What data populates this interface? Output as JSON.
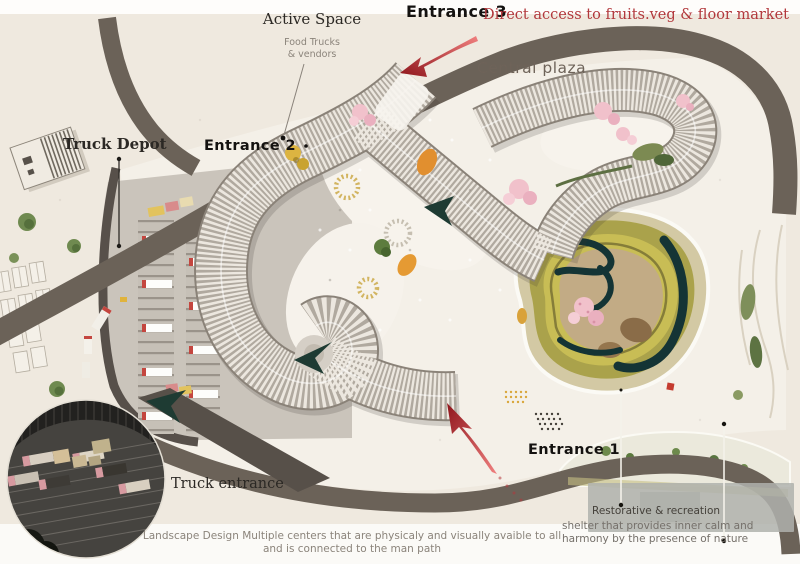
{
  "poster": {
    "entrance3": {
      "title": "Entrance 3",
      "subtitle": "Direct access to  fruits.veg & floor market"
    },
    "active_space": {
      "title": "Active Space",
      "sub1": "Food Trucks",
      "sub2": "& vendors"
    },
    "central_plaza": "Central plaza",
    "truck_depot": "Truck Depot",
    "entrance2": "Entrance 2",
    "entrance1": "Entrance 1",
    "truck_entrance": "Truck entrance",
    "caption": {
      "line1": "Landscape Design Multiple centers that are physicaly and visually avaible to all",
      "line2": "and is connected to the man path"
    },
    "restorative": {
      "title": "Restorative & recreation",
      "line1": "shelter that provides inner calm and",
      "line2": "harmony by the presence of nature"
    },
    "colors": {
      "accent_red": "#b2383c",
      "road": "#6b6258",
      "rib_light": "#ece7df",
      "water_teal": "#143435",
      "terrace_olive": "#aaa24b",
      "blossom_pink": "#f0bfca"
    }
  }
}
